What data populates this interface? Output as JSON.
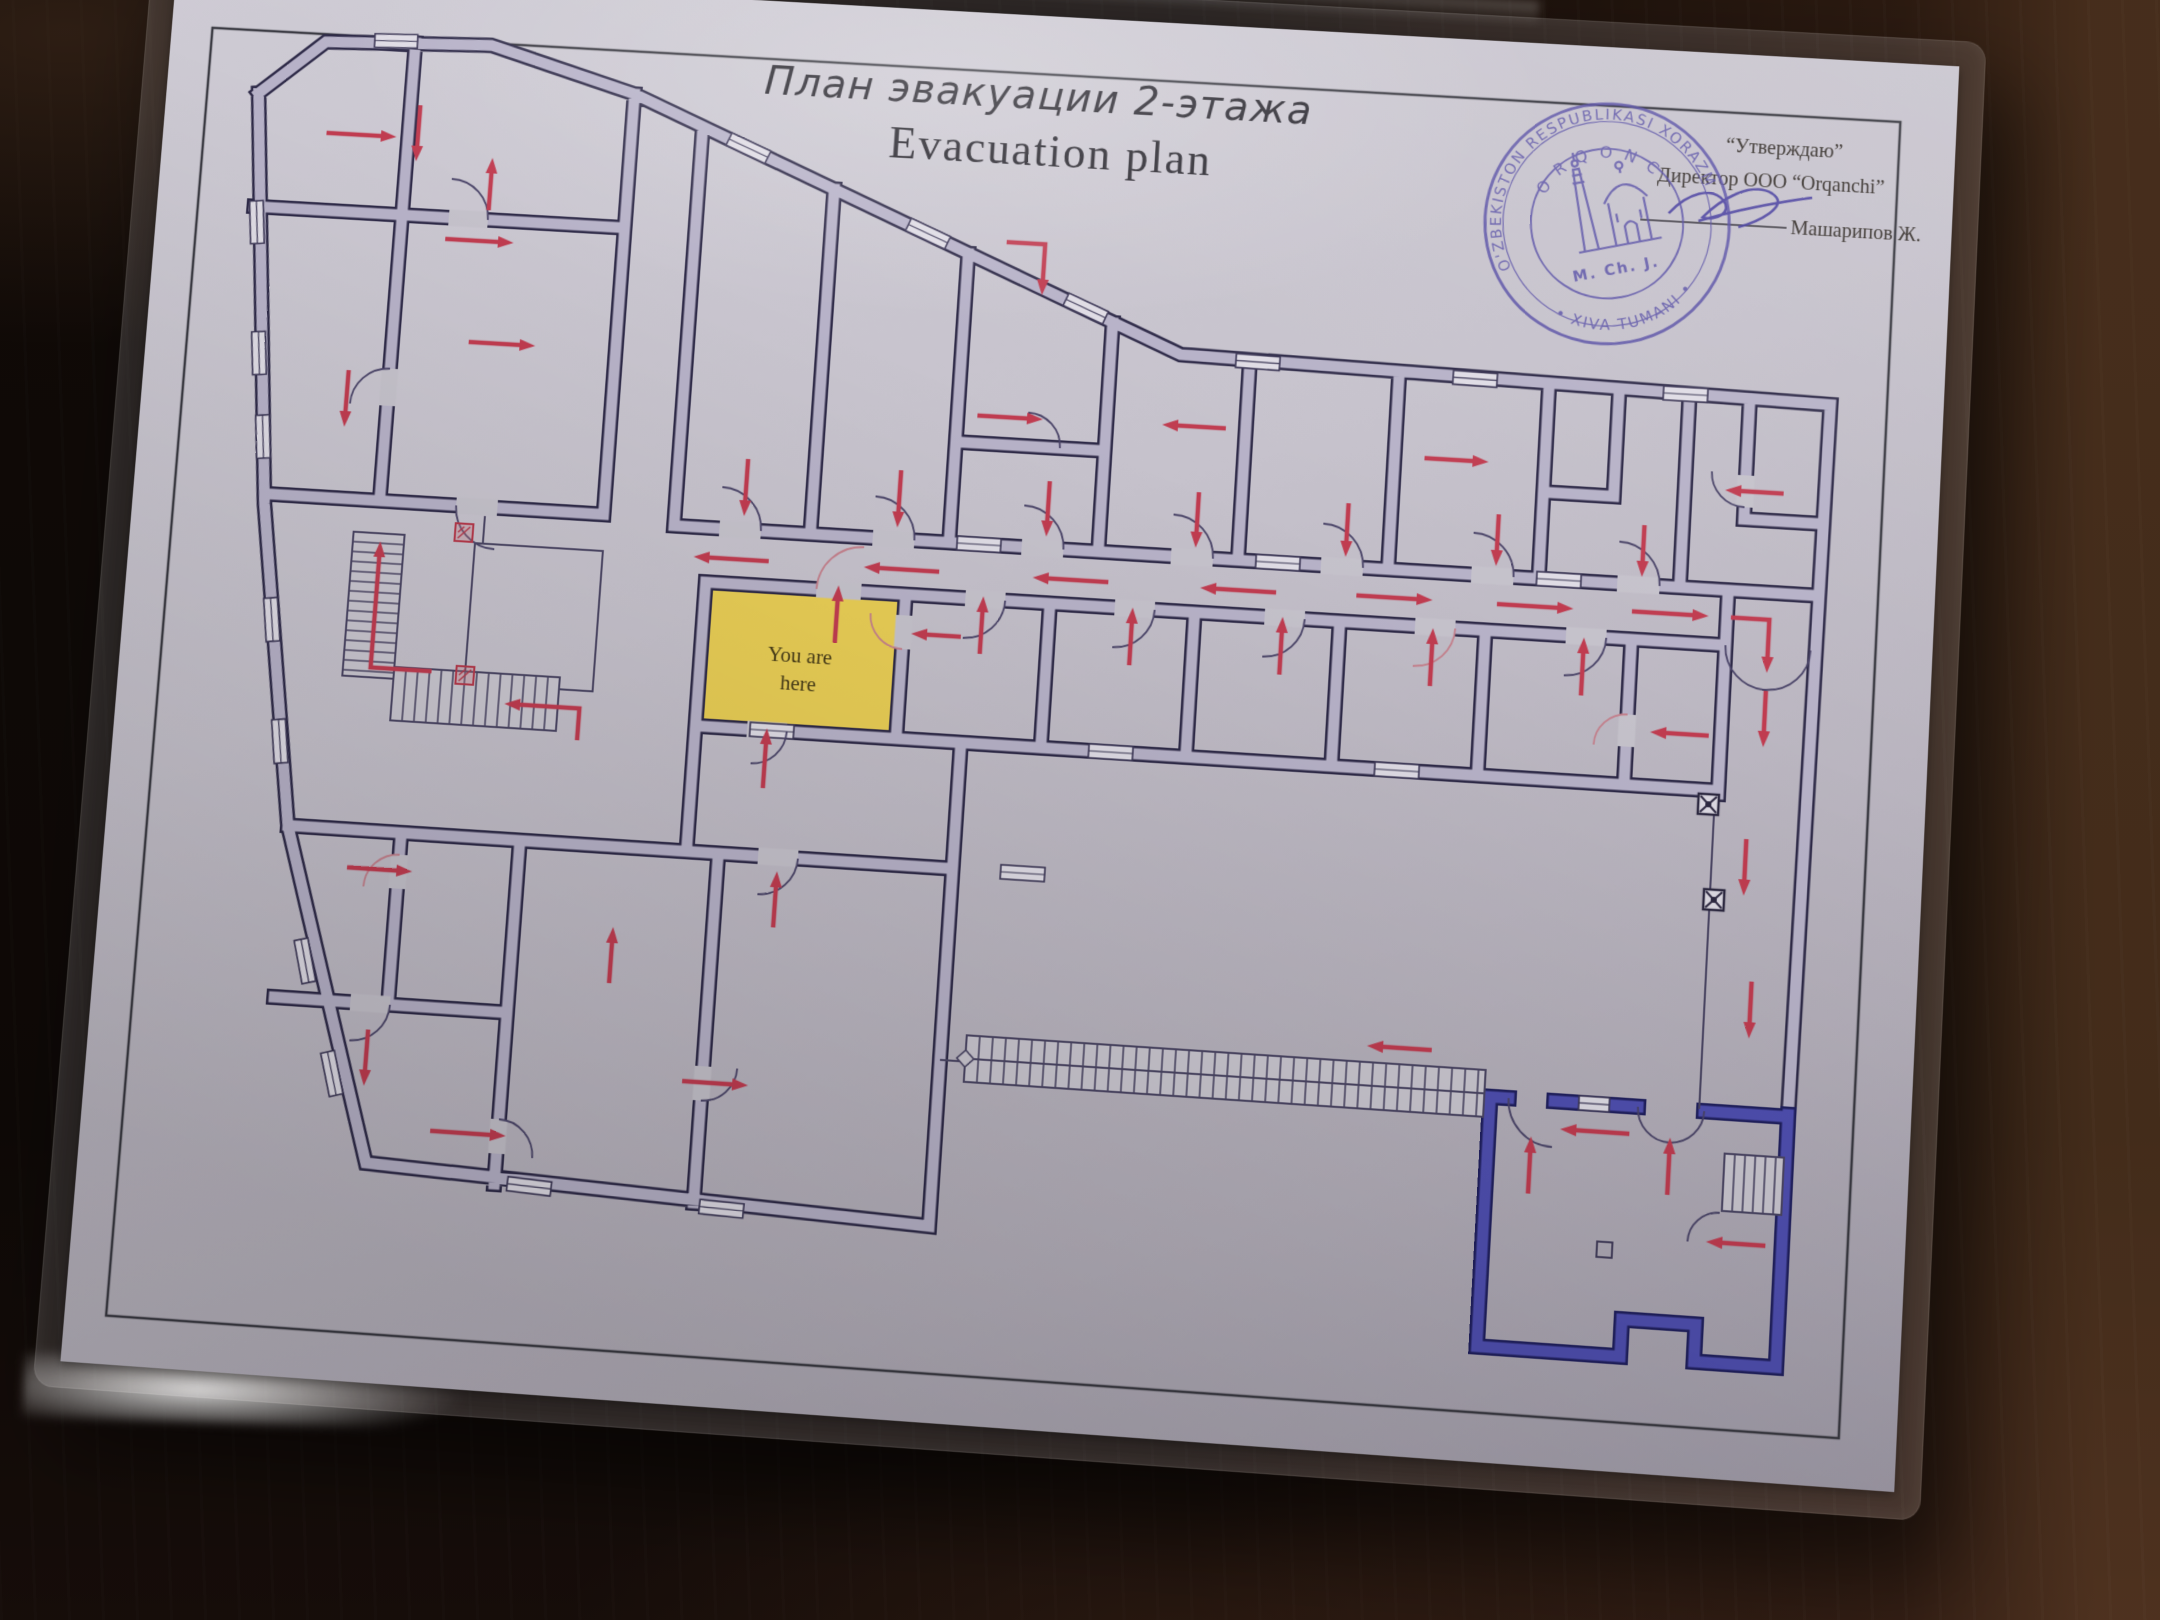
{
  "header": {
    "title_ru": "План эвакуации 2-этажа",
    "title_en": "Evacuation plan"
  },
  "approval": {
    "line1": "“Утверждаю”",
    "line2": "Директор ООО “Orqanchi”",
    "line3": "Машарипов Ж."
  },
  "stamp": {
    "ring_top": "O'ZBEKISTON RESPUBLIKASI XORAZM",
    "ring_bottom": "• XIVA TUMANI •",
    "inner_ring": "ORQONCHI",
    "center": "M. Ch. J.",
    "icon": "minaret-mosque-icon"
  },
  "plan": {
    "you_are_here": {
      "line1": "You are",
      "line2": "here"
    },
    "colors": {
      "wall": "#b7b2c8",
      "wall_outline": "#2d2947",
      "blue_wall": "#4f4fb0",
      "blue_outline": "#20205e",
      "arrow": "#c03c50",
      "you_are_here_fill": "#e8cd55",
      "paper": "#c5c2cb",
      "ink": "#2a2732",
      "stamp_ink": "#584fa6",
      "thin": "#4b4664"
    },
    "arrows": [
      [
        [
          168,
          162
        ],
        [
          240,
          162
        ]
      ],
      [
        [
          262,
          128
        ],
        [
          262,
          186
        ]
      ],
      [
        [
          298,
          264
        ],
        [
          368,
          264
        ]
      ],
      [
        [
          210,
          404
        ],
        [
          210,
          462
        ]
      ],
      [
        [
          340,
          232
        ],
        [
          340,
          178
        ]
      ],
      [
        [
          330,
          368
        ],
        [
          398,
          368
        ]
      ],
      [
        [
          868,
          234
        ],
        [
          907,
          234
        ],
        [
          907,
          286
        ]
      ],
      [
        [
          650,
          572
        ],
        [
          574,
          572
        ]
      ],
      [
        [
          822,
          572
        ],
        [
          746,
          572
        ]
      ],
      [
        [
          992,
          572
        ],
        [
          916,
          572
        ]
      ],
      [
        [
          1160,
          572
        ],
        [
          1084,
          572
        ]
      ],
      [
        [
          1240,
          570
        ],
        [
          1316,
          570
        ]
      ],
      [
        [
          1380,
          570
        ],
        [
          1456,
          570
        ]
      ],
      [
        [
          1514,
          569
        ],
        [
          1590,
          569
        ]
      ],
      [
        [
          1612,
          569
        ],
        [
          1650,
          569
        ],
        [
          1650,
          622
        ]
      ],
      [
        [
          622,
          470
        ],
        [
          622,
          528
        ]
      ],
      [
        [
          777,
          472
        ],
        [
          777,
          530
        ]
      ],
      [
        [
          927,
          474
        ],
        [
          927,
          530
        ]
      ],
      [
        [
          1077,
          476
        ],
        [
          1077,
          532
        ]
      ],
      [
        [
          1227,
          478
        ],
        [
          1227,
          532
        ]
      ],
      [
        [
          1377,
          480
        ],
        [
          1377,
          532
        ]
      ],
      [
        [
          1522,
          482
        ],
        [
          1522,
          534
        ]
      ],
      [
        [
          850,
          412
        ],
        [
          916,
          412
        ]
      ],
      [
        [
          1100,
          410
        ],
        [
          1036,
          410
        ]
      ],
      [
        [
          1300,
          428
        ],
        [
          1364,
          428
        ]
      ],
      [
        [
          1658,
          442
        ],
        [
          1600,
          442
        ]
      ],
      [
        [
          722,
          650
        ],
        [
          722,
          592
        ]
      ],
      [
        [
          868,
          652
        ],
        [
          868,
          594
        ]
      ],
      [
        [
          1018,
          654
        ],
        [
          1018,
          596
        ]
      ],
      [
        [
          1168,
          654
        ],
        [
          1168,
          596
        ]
      ],
      [
        [
          1318,
          656
        ],
        [
          1318,
          598
        ]
      ],
      [
        [
          1468,
          656
        ],
        [
          1468,
          598
        ]
      ],
      [
        [
          848,
          636
        ],
        [
          798,
          636
        ]
      ],
      [
        [
          1596,
          688
        ],
        [
          1538,
          688
        ]
      ],
      [
        [
          1650,
          640
        ],
        [
          1650,
          696
        ]
      ],
      [
        [
          1638,
          788
        ],
        [
          1638,
          844
        ]
      ],
      [
        [
          1650,
          928
        ],
        [
          1650,
          984
        ]
      ],
      [
        [
          318,
          704
        ],
        [
          256,
          704
        ],
        [
          256,
          576
        ]
      ],
      [
        [
          470,
          764
        ],
        [
          470,
          732
        ],
        [
          394,
          732
        ]
      ],
      [
        [
          248,
          906
        ],
        [
          314,
          906
        ]
      ],
      [
        [
          282,
          1066
        ],
        [
          282,
          1122
        ]
      ],
      [
        [
          352,
          1162
        ],
        [
          428,
          1162
        ]
      ],
      [
        [
          520,
          1004
        ],
        [
          520,
          948
        ]
      ],
      [
        [
          680,
          938
        ],
        [
          680,
          882
        ]
      ],
      [
        [
          600,
          1096
        ],
        [
          666,
          1096
        ]
      ],
      [
        [
          660,
          800
        ],
        [
          660,
          740
        ]
      ],
      [
        [
          1340,
          1016
        ],
        [
          1276,
          1016
        ]
      ],
      [
        [
          1538,
          1085
        ],
        [
          1470,
          1085
        ]
      ],
      [
        [
          1442,
          1150
        ],
        [
          1442,
          1094
        ]
      ],
      [
        [
          1578,
          1142
        ],
        [
          1578,
          1086
        ]
      ],
      [
        [
          1676,
          1185
        ],
        [
          1618,
          1185
        ]
      ]
    ],
    "doors": [
      {
        "d": "M 640 542 A 42 42 0 0 0 598 500"
      },
      {
        "d": "M 795 542 A 42 42 0 0 0 753 500"
      },
      {
        "d": "M 945 542 A 42 42 0 0 0 903 500"
      },
      {
        "d": "M 1095 542 A 42 42 0 0 0 1053 500"
      },
      {
        "d": "M 1245 542 A 42 42 0 0 0 1203 500"
      },
      {
        "d": "M 1395 542 A 42 42 0 0 0 1353 500"
      },
      {
        "d": "M 1540 542 A 42 42 0 0 0 1498 500"
      },
      {
        "d": "M 700 597 A 45 45 0 0 1 745 552",
        "red": true
      },
      {
        "d": "M 890 597 A 40 40 0 0 1 850 637"
      },
      {
        "d": "M 1040 597 A 40 40 0 0 1 1000 637"
      },
      {
        "d": "M 1190 597 A 40 40 0 0 1 1150 637"
      },
      {
        "d": "M 1340 597 A 40 40 0 0 1 1300 637",
        "red": true
      },
      {
        "d": "M 1490 597 A 40 40 0 0 1 1450 637"
      },
      {
        "d": "M 1608 597 A 42 42 0 0 0 1650 639"
      },
      {
        "d": "M 1692 597 A 42 42 0 0 1 1650 639"
      },
      {
        "d": "M 1545 1058 A 33 33 0 0 0 1578 1091"
      },
      {
        "d": "M 1610 1058 A 33 33 0 0 1 1578 1091"
      },
      {
        "d": "M 1418 1058 A 45 45 0 0 0 1463 1103"
      },
      {
        "d": "M 1630 1156 A 30 30 0 0 0 1600 1186"
      },
      {
        "d": "M 340 242 A 40 40 0 0 0 300 202"
      },
      {
        "d": "M 252 400 A 38 38 0 0 0 214 438"
      },
      {
        "d": "M 330 535 A 42 42 0 0 0 372 577"
      },
      {
        "d": "M 700 868 A 38 38 0 0 1 662 906"
      },
      {
        "d": "M 790 652 A 34 34 0 0 1 756 618",
        "red": true
      },
      {
        "d": "M 1515 672 A 32 32 0 0 0 1483 704",
        "red": true
      },
      {
        "d": "M 1620 458 A 34 34 0 0 1 1586 424"
      },
      {
        "d": "M 935 440 A 34 34 0 0 0 901 406"
      },
      {
        "d": "M 680 742 A 34 34 0 0 1 646 776"
      },
      {
        "d": "M 420 1146 A 36 36 0 0 1 456 1182"
      },
      {
        "d": "M 620 1114 A 34 34 0 0 0 654 1080"
      },
      {
        "d": "M 300 890 A 34 34 0 0 0 266 924",
        "red": true
      },
      {
        "d": "M 302 1040 A 38 38 0 0 1 264 1078"
      }
    ],
    "openings": [
      [
        598,
        542,
        640,
        542
      ],
      [
        753,
        542,
        795,
        542
      ],
      [
        903,
        542,
        945,
        542
      ],
      [
        1053,
        542,
        1095,
        542
      ],
      [
        1203,
        542,
        1245,
        542
      ],
      [
        1353,
        542,
        1395,
        542
      ],
      [
        1498,
        542,
        1540,
        542
      ],
      [
        700,
        597,
        745,
        597
      ],
      [
        850,
        597,
        890,
        597
      ],
      [
        1000,
        597,
        1040,
        597
      ],
      [
        1150,
        597,
        1190,
        597
      ],
      [
        1300,
        597,
        1340,
        597
      ],
      [
        1450,
        597,
        1490,
        597
      ],
      [
        300,
        242,
        340,
        242
      ],
      [
        252,
        400,
        252,
        438
      ],
      [
        330,
        535,
        372,
        535
      ],
      [
        660,
        868,
        700,
        868
      ],
      [
        300,
        890,
        300,
        924
      ],
      [
        420,
        1146,
        420,
        1180
      ],
      [
        620,
        1080,
        620,
        1114
      ],
      [
        790,
        618,
        790,
        652
      ],
      [
        1515,
        672,
        1515,
        704
      ],
      [
        1620,
        426,
        1620,
        458
      ],
      [
        640,
        742,
        680,
        742
      ],
      [
        262,
        1040,
        302,
        1040
      ]
    ],
    "windows": [
      [
        232,
        63,
        -2
      ],
      [
        104,
        258,
        84
      ],
      [
        117,
        392,
        84
      ],
      [
        128,
        477,
        84
      ],
      [
        152,
        662,
        82
      ],
      [
        170,
        784,
        82
      ],
      [
        213,
        1002,
        75
      ],
      [
        249,
        1112,
        74
      ],
      [
        455,
        1210,
        3
      ],
      [
        648,
        1219,
        2
      ],
      [
        600,
        153,
        22
      ],
      [
        788,
        230,
        22
      ],
      [
        952,
        297,
        22
      ],
      [
        1128,
        341,
        1
      ],
      [
        1346,
        345,
        1
      ],
      [
        1556,
        348,
        0
      ],
      [
        860,
        542,
        0
      ],
      [
        1160,
        542,
        0
      ],
      [
        1440,
        542,
        0
      ],
      [
        665,
        742,
        0
      ],
      [
        1005,
        742,
        0
      ],
      [
        1290,
        742,
        0
      ],
      [
        1502,
        1058,
        0,
        30
      ],
      [
        925,
        868,
        0
      ]
    ],
    "stairs": [
      {
        "x": 228,
        "y": 568,
        "w": 52,
        "h": 146,
        "dir": "v",
        "step": 10
      },
      {
        "x": 280,
        "y": 702,
        "w": 168,
        "h": 54,
        "dir": "h",
        "step": 12
      },
      {
        "x": 880,
        "y": 1032,
        "w": 514,
        "h": 46,
        "dir": "h",
        "step": 13,
        "mid": true,
        "diamond": true
      },
      {
        "x": 1632,
        "y": 1098,
        "w": 58,
        "h": 56,
        "dir": "h",
        "step": 10
      }
    ],
    "icons": [
      {
        "t": "electrical-panel-icon",
        "x": 331,
        "y": 553,
        "s": 18
      },
      {
        "t": "electrical-panel-icon",
        "x": 343,
        "y": 697,
        "s": 18
      },
      {
        "t": "junction-box-icon",
        "x": 1589,
        "y": 746,
        "s": 20
      },
      {
        "t": "junction-box-icon",
        "x": 1599,
        "y": 840,
        "s": 20
      },
      {
        "t": "floor-drain-icon",
        "x": 1512,
        "y": 1192,
        "s": 15
      }
    ],
    "walls_gray": "M 95 125 L 160 68 L 330 62 L 480 104 L 1050 338 L 1700 350 L 1692 1058 M 95 125 L 135 545 L 185 868 L 290 1198 L 855 1222 L 855 742 M 100 242 L 480 242 M 252 64 L 252 535 M 135 535 L 480 535 M 480 104 L 480 535 M 552 140 L 552 542 M 690 190 L 690 542 M 830 248 L 830 542 M 980 310 L 980 542 M 830 440 L 980 440 M 1120 342 L 1120 542 M 1270 346 L 1270 542 M 1420 349 L 1420 542 M 1420 455 L 1490 455 M 1490 349 L 1490 455 M 1560 350 L 1560 542 M 1620 350 L 1620 470 M 1620 470 L 1692 470 M 555 542 L 1692 542 M 588 597 L 1608 597 M 1608 542 L 1608 745 M 588 597 L 588 868 M 790 597 L 790 742 M 935 597 L 935 742 M 1080 597 L 1080 742 M 1225 597 L 1225 742 M 1370 597 L 1370 742 M 1515 597 L 1515 742 M 588 742 L 1608 742 M 185 868 L 855 868 M 300 868 L 300 1040 M 420 868 L 420 1210 M 620 868 L 620 1215 M 185 1040 L 420 1040",
    "walls_blue": "M 1400 1058 L 1418 1058 M 1463 1058 L 1545 1058 M 1610 1058 L 1692 1058 M 1400 1058 L 1400 1302 L 1540 1302 L 1540 1266 L 1612 1266 L 1612 1302 L 1692 1302 L 1692 1056",
    "thin_lines": "M 1605 745 L 1605 1056 M 855 1058 L 884 1058 M 352 572 L 482 572 L 482 714 L 352 714 L 352 572 M 360 572 L 360 544"
  }
}
